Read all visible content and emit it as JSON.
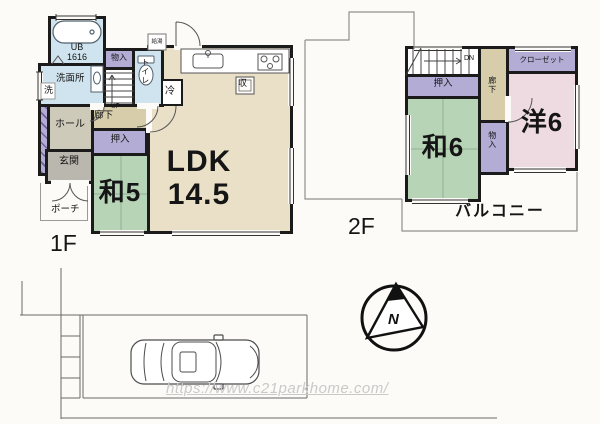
{
  "palette": {
    "wall": "#1b1b1b",
    "wet_area_blue": "#cfe4ee",
    "closet_purple": "#b3acd4",
    "tatami_green": "#b7d5b6",
    "ldk_beige": "#eadfc7",
    "corridor_tan": "#d7cdab",
    "hall_gray": "#cecaba",
    "entrance_gray": "#bab7af",
    "western_pink": "#eddbe1",
    "watermark_gray": "#c9c9c9"
  },
  "floor1": {
    "label": "1F",
    "bath_name": "UB",
    "bath_size": "1616",
    "washroom": "洗面所",
    "washer": "洗",
    "storage": "物入",
    "toilet": "トイレ",
    "water_heater": "給湯",
    "fridge": "冷",
    "corridor": "廊下",
    "stairs_up": "UP",
    "hall": "ホール",
    "entrance": "玄関",
    "porch": "ポーチ",
    "closet": "押入",
    "tatami_room": "和5",
    "ldk_name": "LDK",
    "ldk_size": "14.5",
    "kitchen_storage": "収"
  },
  "floor2": {
    "label": "2F",
    "stairs_down": "DN",
    "closet_oshiire": "押入",
    "corridor": "廊下",
    "closet_wardrobe": "クローゼット",
    "western_room": "洋6",
    "tatami_room": "和6",
    "storage": "物入",
    "balcony": "バルコニー"
  },
  "compass": {
    "label": "N"
  },
  "watermark": {
    "url": "https://www.c21parkhome.com/"
  }
}
